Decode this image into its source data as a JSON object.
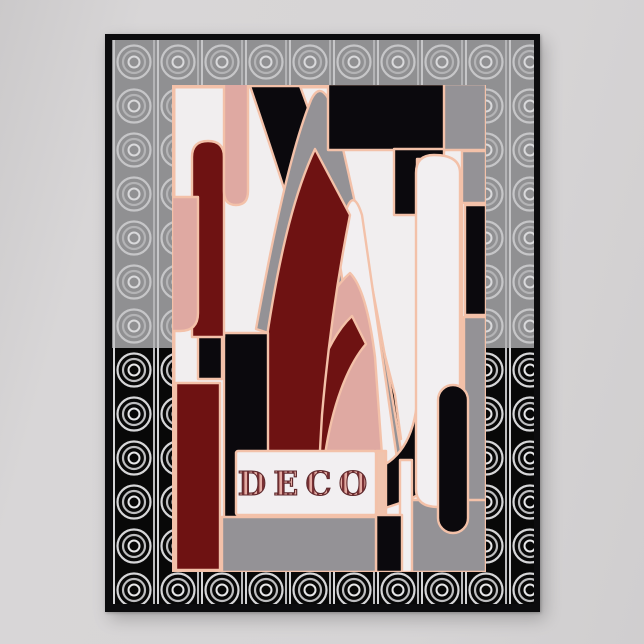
{
  "artwork": {
    "label": "DECO",
    "style_description": "art deco abstract stained-glass composition",
    "background_pattern": "concentric ring arch deco pattern",
    "palette": {
      "wall": "#d5d3d4",
      "frame_black": "#0c0c0e",
      "pattern_gray_bg": "#909092",
      "pattern_gray_line": "#c0c0c2",
      "pattern_black_bg": "#080808",
      "pattern_black_line": "#d6d6d8",
      "outline_peach": "#f3c1a9",
      "panel_offwhite": "#f1eeef",
      "fill_maroon": "#6e1212",
      "fill_pink": "#dfa9a2",
      "fill_gray": "#949296",
      "fill_black": "#0b090d",
      "label_letter_color": "#5f2a2e"
    }
  }
}
